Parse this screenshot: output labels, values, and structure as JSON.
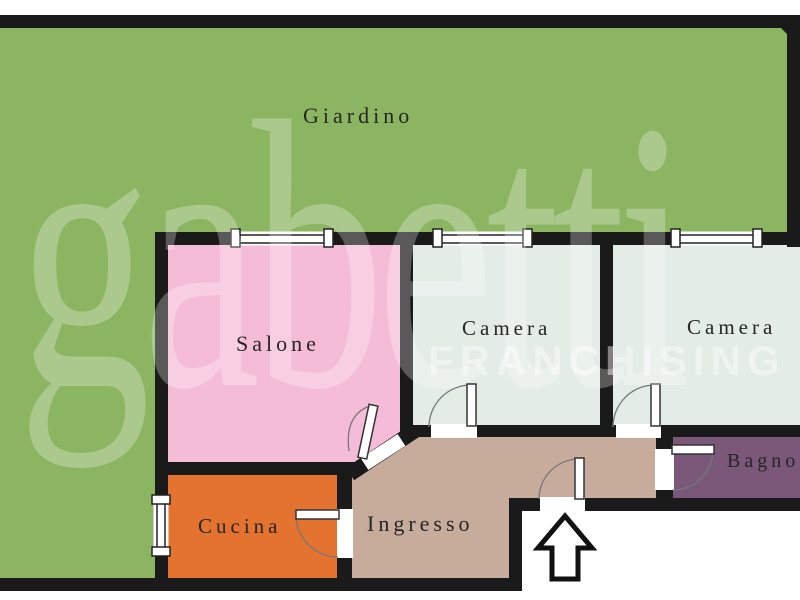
{
  "plan": {
    "type": "floor-plan"
  },
  "watermark": {
    "brand": "gabetti",
    "subtitle": "FRANCHISING"
  },
  "colors": {
    "wall": "#1a1a1a",
    "background": "#ffffff",
    "window_line": "#222222",
    "door_outline": "#333333",
    "door_arc": "#777777",
    "arrow_outline": "#111111"
  },
  "rooms": [
    {
      "id": "giardino",
      "label": "Giardino",
      "color": "#8bb560"
    },
    {
      "id": "salone",
      "label": "Salone",
      "color": "#f4bcd7"
    },
    {
      "id": "camera-1",
      "label": "Camera",
      "color": "#e4ece6"
    },
    {
      "id": "camera-2",
      "label": "Camera",
      "color": "#e4ece6"
    },
    {
      "id": "bagno",
      "label": "Bagno",
      "color": "#7b587a"
    },
    {
      "id": "cucina",
      "label": "Cucina",
      "color": "#e4732f"
    },
    {
      "id": "ingresso",
      "label": "Ingresso",
      "color": "#c7ac9c"
    }
  ],
  "icons": {
    "entrance_arrow": "arrow-up-icon"
  }
}
